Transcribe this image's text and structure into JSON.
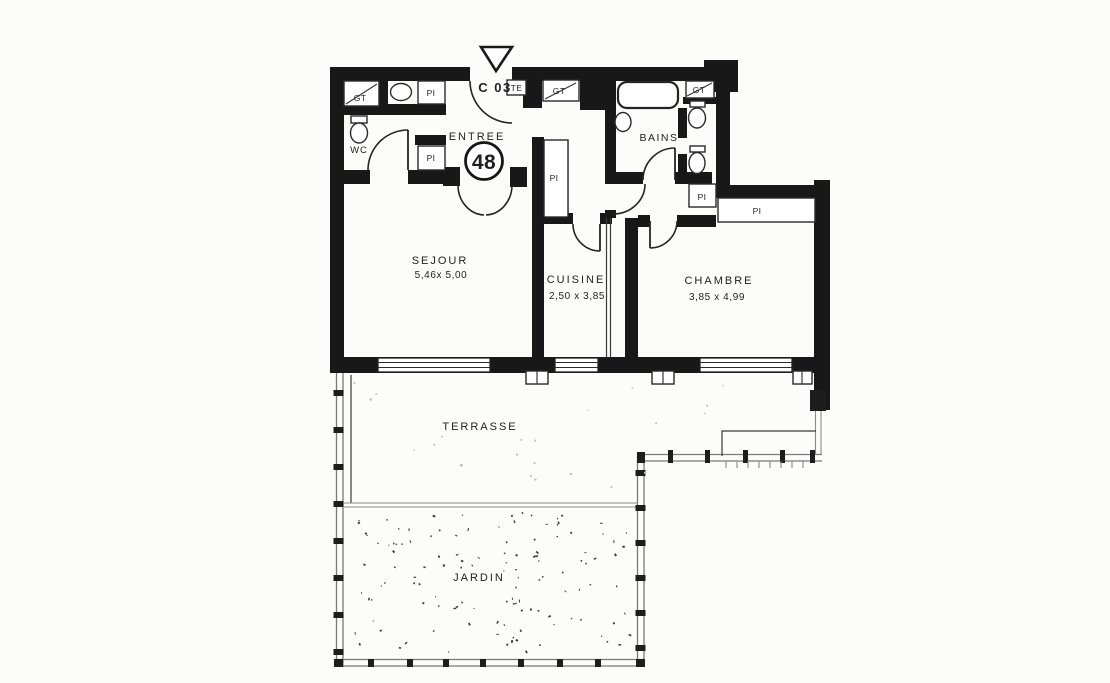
{
  "plan": {
    "unit_code": "C 03",
    "te_label": "TE",
    "unit_number": "48",
    "entry_label": "ENTREE",
    "rooms": {
      "sejour": {
        "name": "SEJOUR",
        "dimensions": "5,46x 5,00"
      },
      "cuisine": {
        "name": "CUISINE",
        "dimensions": "2,50 x 3,85"
      },
      "chambre": {
        "name": "CHAMBRE",
        "dimensions": "3,85 x 4,99"
      },
      "bains": {
        "name": "BAINS"
      },
      "wc": {
        "name": "WC"
      },
      "terrasse": {
        "name": "TERRASSE"
      },
      "jardin": {
        "name": "JARDIN"
      }
    },
    "closet_labels": {
      "gt": "GT",
      "pi": "PI"
    },
    "colors": {
      "wall": "#181818",
      "paper": "#fcfcfa",
      "fence": "#787878",
      "ink": "#1f1f1f"
    }
  }
}
